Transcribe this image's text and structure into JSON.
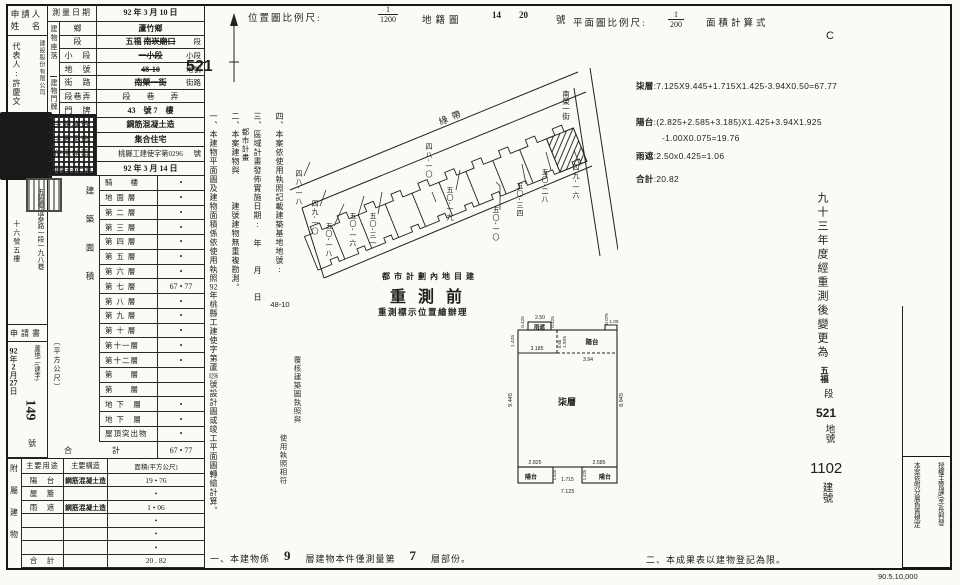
{
  "sheet": {
    "print_code": "90.5.10,000",
    "mark_c": "C"
  },
  "header": {
    "survey_date_label": "測量日期",
    "survey_date": "92 年 3 月 10 日",
    "loc_scale_label": "位置圖比例尺:",
    "loc_scale_num": "1",
    "loc_scale_den": "1200",
    "cadastral_label": "地籍圖",
    "cadastral_no1": "14",
    "cadastral_no2": "20",
    "cadastral_unit": "號",
    "plan_scale_label": "平面圖比例尺:",
    "plan_scale_num": "1",
    "plan_scale_den": "200",
    "area_calc_label": "面積計算式",
    "handwritten_lot": "521"
  },
  "applicant": {
    "title_line1": "申請人",
    "title_line2": "姓　名",
    "company": "建設股份有限公司",
    "rep": "代表人:許慶文",
    "address_right": "五股鄉成泰路一段一九八巷",
    "address_left": "十六號五樓",
    "application": "申請書",
    "receipt_y": "92",
    "receipt_y_unit": "年",
    "receipt_m": "2",
    "receipt_m_unit": "月",
    "receipt_d": "27",
    "receipt_d_unit": "日",
    "receipt_prefix": "蘆地二(建字)",
    "receipt_no": "149",
    "receipt_unit": "號"
  },
  "location": {
    "group_site": "建物座落",
    "group_door": "建物門牌",
    "village_label": "鄉",
    "village_value": "蘆竹鄉",
    "sec_label": "段",
    "sec_hand": "五福",
    "sec_strike": "南崁廟口",
    "sec_suffix": "段",
    "subsec_label": "小　段",
    "subsec_strike": "一小段",
    "subsec_suffix": "小段",
    "lot_label": "地　號",
    "lot_strike": "48-10",
    "lot_suffix": "地號",
    "street_label": "街　路",
    "street_strike": "南榮一街",
    "street_suffix": "街路",
    "lane_label": "段巷弄",
    "lane_value": "段　　巷　　弄",
    "door_label": "門　牌",
    "door_value": "43　號 7　樓"
  },
  "building_info": {
    "structure_label": "主體構造",
    "structure_value": "鋼筋混凝土造",
    "use_label": "主要用途",
    "use_value": "集合住宅",
    "license_label": "使用執照",
    "license_value": "桃縣工建使字第0296",
    "license_unit": "號",
    "complete_label": "建築完成日期",
    "complete_value": "92 年 3 月 14 日"
  },
  "floor_table": {
    "side_label": "建築面積",
    "side_unit": "（平方公尺）",
    "rows": [
      {
        "label": "騎　　樓",
        "value": "•"
      },
      {
        "label": "地 面 層",
        "value": "•"
      },
      {
        "label": "第 二 層",
        "value": "•"
      },
      {
        "label": "第 三 層",
        "value": "•"
      },
      {
        "label": "第 四 層",
        "value": "•"
      },
      {
        "label": "第 五 層",
        "value": "•"
      },
      {
        "label": "第 六 層",
        "value": "•"
      },
      {
        "label": "第 七 層",
        "value": "67 • 77"
      },
      {
        "label": "第 八 層",
        "value": "•"
      },
      {
        "label": "第 九 層",
        "value": "•"
      },
      {
        "label": "第 十 層",
        "value": "•"
      },
      {
        "label": "第十一層",
        "value": "•"
      },
      {
        "label": "第十二層",
        "value": "•"
      },
      {
        "label": "第　　層",
        "value": ""
      },
      {
        "label": "第　　層",
        "value": ""
      },
      {
        "label": "地 下　層",
        "value": "•"
      },
      {
        "label": "地 下　層",
        "value": "•"
      },
      {
        "label": "屋頂突出物",
        "value": "•"
      }
    ],
    "total_label": "合　　計",
    "total_value": "67 • 77"
  },
  "annex_table": {
    "side_label": "附屬建物",
    "h_use": "主要用途",
    "h_structure": "主要構造",
    "h_area": "面積(平方公尺)",
    "rows": [
      {
        "use": "陽　台",
        "structure": "鋼筋混凝土造",
        "area": "19 • 76"
      },
      {
        "use": "屋　簷",
        "structure": "",
        "area": "•"
      },
      {
        "use": "雨　遮",
        "structure": "鋼筋混凝土造",
        "area": "1 • 06"
      },
      {
        "use": "",
        "structure": "",
        "area": "•"
      },
      {
        "use": "",
        "structure": "",
        "area": "•"
      },
      {
        "use": "",
        "structure": "",
        "area": "•"
      },
      {
        "use": "合　計",
        "structure": "",
        "area": "20 . 82"
      }
    ]
  },
  "mid_notes": {
    "n1_pre": "一、本建物平面圖及建物面積係依使用執照",
    "n1_no1": "92",
    "n1_mid": "年桃縣工建使字第蘆",
    "n1_no2": "0296",
    "n1_post": "號設計圖或竣工平面圖轉繪計算。",
    "n2": "二、本案建物與　　　建號建物無重複勘測。",
    "n3": "三、區域計畫發佈實施日期:　年　　月　　日",
    "n3_sub": "都市計畫",
    "n4": "四、本案依使用執照記載建築基地地號:",
    "n4_no": "48-10",
    "verify_1": "覆核建築圖執照與",
    "verify_2": "使用執照相符"
  },
  "stamps": {
    "urban": "都市計劃內地目建",
    "retest": "重測前",
    "retest_sub": "重測標示位置繪辦理"
  },
  "site_plan": {
    "green_belt": "綠帶",
    "street": "南榮一街",
    "lot_48_18": "四八-一八",
    "lot_49_10": "四九-一〇",
    "lot_50_18": "五〇-一八",
    "lot_50_16": "五〇-一六",
    "lot_50_31": "五〇-三一",
    "lot_48_10": "四八-一〇",
    "lot_50_19": "五〇-一九",
    "lot_50_10": "五〇-一〇",
    "lot_50_34": "五〇-三四",
    "lot_50_28": "五〇-二八",
    "lot_49_16": "四九-一六"
  },
  "calc": {
    "l1_label": "柒層",
    "l1_body": ":7.125X9.445+1.715X1.425-3.94X0.50=67.77",
    "l2_label": "陽台",
    "l2_body": ":(2.825+2.585+3.185)X1.425+3.94X1.925",
    "l3_body": "-1.00X0.075=19.76",
    "l4_label": "雨遮",
    "l4_body": ":2.50x0.425=1.06",
    "l5_label": "合計",
    "l5_body": ":20.82"
  },
  "floor_plan": {
    "room": "柒層",
    "balcony": "陽台",
    "eave": "雨遮",
    "d_0425_l": "0.425",
    "d_250": "2.50",
    "d_0425_r": "0.425",
    "d_0075": "0.075",
    "d_100": "1.00",
    "d_1425_tl": "1.425",
    "d_3185": "3.185",
    "d_050": "0.50",
    "d_1925": "1.925",
    "d_394": "3.94",
    "d_9445": "9.445",
    "d_8945": "8.945",
    "d_2825": "2.825",
    "d_2585": "2.585",
    "d_1425_bl": "1.425",
    "d_1425_br": "1.425",
    "d_1715": "1.715",
    "d_7125": "7.125"
  },
  "bottom_notes": {
    "n1_pre": "一、本建物係",
    "n1_no1": "9",
    "n1_mid": "層建物本件僅測量第",
    "n1_no2": "7",
    "n1_post": "層部份。",
    "n2": "二、本成果表以建物登記為限。"
  },
  "right_strip": {
    "retest_text": "九十三年度經重測後變更為",
    "sec_hand": "五福",
    "sec_unit": "段",
    "lot_no": "521",
    "lot_unit": "地號",
    "bldg_no": "1102",
    "bldg_unit": "建號"
  },
  "auth": {
    "col_right": "授權主管課(室)長判發",
    "col_left": "本案依照分層負責規定"
  }
}
